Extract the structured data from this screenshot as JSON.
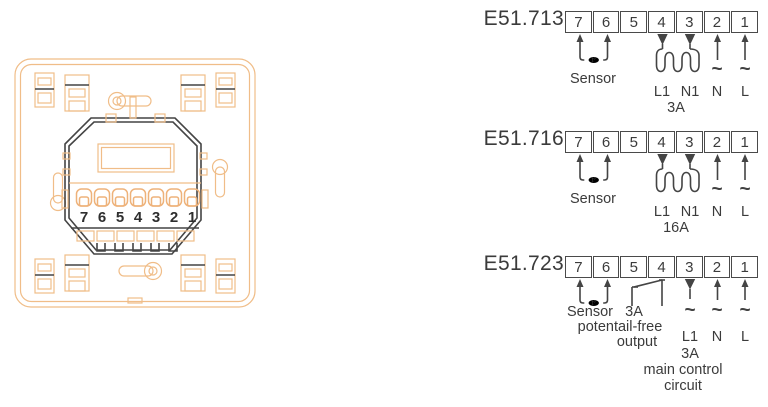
{
  "colors": {
    "device_outline": "#f0bd88",
    "ink": "#3b3b3b"
  },
  "device": {
    "terminal_numbers": [
      "7",
      "6",
      "5",
      "4",
      "3",
      "2",
      "1"
    ]
  },
  "diagrams": [
    {
      "model": "E51.713",
      "terminals": [
        "7",
        "6",
        "5",
        "4",
        "3",
        "2",
        "1"
      ],
      "labels": {
        "sensor": "Sensor",
        "sensor_symbol": "t°",
        "l1": "L1",
        "n1": "N1",
        "load_rating": "3A",
        "neutral": "N",
        "line": "L",
        "tilde": "~"
      }
    },
    {
      "model": "E51.716",
      "terminals": [
        "7",
        "6",
        "5",
        "4",
        "3",
        "2",
        "1"
      ],
      "labels": {
        "sensor": "Sensor",
        "sensor_symbol": "t°",
        "l1": "L1",
        "n1": "N1",
        "load_rating": "16A",
        "neutral": "N",
        "line": "L",
        "tilde": "~"
      }
    },
    {
      "model": "E51.723",
      "terminals": [
        "7",
        "6",
        "5",
        "4",
        "3",
        "2",
        "1"
      ],
      "labels": {
        "sensor": "Sensor",
        "sensor_symbol": "t°",
        "switch_rating": "3A",
        "switch_line1": "potentail-free",
        "switch_line2": "output",
        "l1": "L1",
        "l1_rating": "3A",
        "neutral": "N",
        "line": "L",
        "tilde": "~",
        "circuit_line1": "main control",
        "circuit_line2": "circuit"
      }
    }
  ]
}
